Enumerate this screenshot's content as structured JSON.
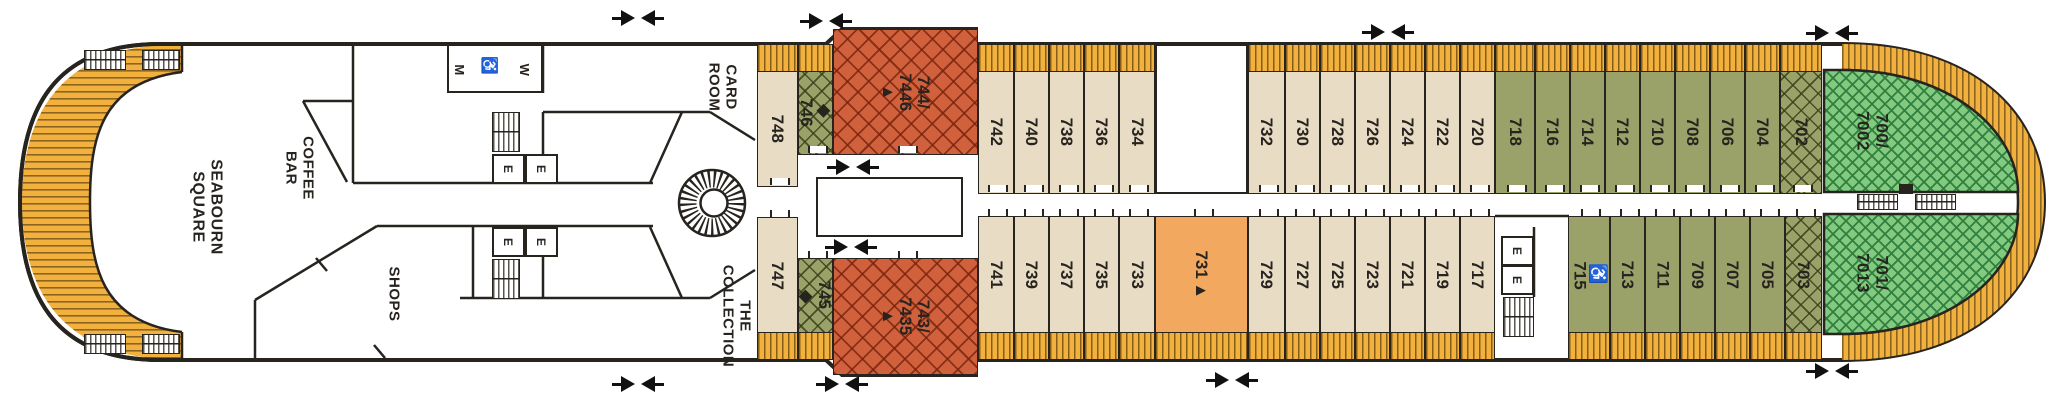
{
  "venues": {
    "seabourn_square": {
      "label": "SEABOURN\nSQUARE"
    },
    "coffee_bar": {
      "label": "COFFEE\nBAR"
    },
    "shops": {
      "label": "SHOPS"
    },
    "card_room": {
      "label": "CARD\nROOM"
    },
    "the_collection": {
      "label": "THE\nCOLLECTION"
    }
  },
  "facilities": {
    "mens": "M",
    "womens": "W",
    "elevator": "E",
    "accessible_icon": "♿"
  },
  "markers": {
    "diamond": "◆",
    "triangle": "▲"
  },
  "colors": {
    "hull_line": "#27231f",
    "cabin_beige": "#e8dcc4",
    "cabin_olive": "#9aa26a",
    "suite_red": "#d0613c",
    "suite_green": "#82ca7f",
    "suite_orange": "#f2a95f",
    "deck_yellow": "#f2b13c"
  },
  "cabins": {
    "top": [
      {
        "n": "748",
        "x": 757,
        "w": 41,
        "c": "beige",
        "f": "aft"
      },
      {
        "n": "746",
        "x": 798,
        "w": 35,
        "c": "olive-x",
        "pre": "◆",
        "f": "short"
      },
      {
        "n": "744/7446",
        "lines": [
          "744/",
          "7446"
        ],
        "x": 833,
        "w": 145,
        "c": "red-x",
        "tri": true,
        "f": "tall"
      },
      {
        "n": "742",
        "x": 978,
        "w": 36,
        "c": "beige"
      },
      {
        "n": "740",
        "x": 1014,
        "w": 35,
        "c": "beige"
      },
      {
        "n": "738",
        "x": 1049,
        "w": 35,
        "c": "beige"
      },
      {
        "n": "736",
        "x": 1084,
        "w": 35,
        "c": "beige"
      },
      {
        "n": "734",
        "x": 1119,
        "w": 36,
        "c": "beige"
      },
      {
        "n": "732",
        "x": 1248,
        "w": 37,
        "c": "beige"
      },
      {
        "n": "730",
        "x": 1285,
        "w": 35,
        "c": "beige"
      },
      {
        "n": "728",
        "x": 1320,
        "w": 35,
        "c": "beige"
      },
      {
        "n": "726",
        "x": 1355,
        "w": 35,
        "c": "beige"
      },
      {
        "n": "724",
        "x": 1390,
        "w": 35,
        "c": "beige"
      },
      {
        "n": "722",
        "x": 1425,
        "w": 35,
        "c": "beige"
      },
      {
        "n": "720",
        "x": 1460,
        "w": 35,
        "c": "beige"
      },
      {
        "n": "718",
        "x": 1495,
        "w": 40,
        "c": "olive"
      },
      {
        "n": "716",
        "x": 1535,
        "w": 35,
        "c": "olive"
      },
      {
        "n": "714",
        "x": 1570,
        "w": 35,
        "c": "olive"
      },
      {
        "n": "712",
        "x": 1605,
        "w": 35,
        "c": "olive"
      },
      {
        "n": "710",
        "x": 1640,
        "w": 35,
        "c": "olive"
      },
      {
        "n": "708",
        "x": 1675,
        "w": 35,
        "c": "olive"
      },
      {
        "n": "706",
        "x": 1710,
        "w": 35,
        "c": "olive"
      },
      {
        "n": "704",
        "x": 1745,
        "w": 35,
        "c": "olive"
      },
      {
        "n": "702",
        "x": 1780,
        "w": 42,
        "c": "olive-x"
      }
    ],
    "bottom": [
      {
        "n": "747",
        "x": 757,
        "w": 41,
        "c": "beige",
        "f": "aft"
      },
      {
        "n": "745",
        "x": 798,
        "w": 35,
        "c": "olive-x",
        "post": "◆",
        "f": "short"
      },
      {
        "n": "743/7435",
        "lines": [
          "743/",
          "7435"
        ],
        "x": 833,
        "w": 145,
        "c": "red-x",
        "tri": true,
        "f": "tall"
      },
      {
        "n": "741",
        "x": 978,
        "w": 36,
        "c": "beige"
      },
      {
        "n": "739",
        "x": 1014,
        "w": 35,
        "c": "beige"
      },
      {
        "n": "737",
        "x": 1049,
        "w": 35,
        "c": "beige"
      },
      {
        "n": "735",
        "x": 1084,
        "w": 35,
        "c": "beige"
      },
      {
        "n": "733",
        "x": 1119,
        "w": 36,
        "c": "beige"
      },
      {
        "n": "731",
        "x": 1155,
        "w": 93,
        "c": "orange",
        "post": "▲"
      },
      {
        "n": "729",
        "x": 1248,
        "w": 37,
        "c": "beige"
      },
      {
        "n": "727",
        "x": 1285,
        "w": 35,
        "c": "beige"
      },
      {
        "n": "725",
        "x": 1320,
        "w": 35,
        "c": "beige"
      },
      {
        "n": "723",
        "x": 1355,
        "w": 35,
        "c": "beige"
      },
      {
        "n": "721",
        "x": 1390,
        "w": 35,
        "c": "beige"
      },
      {
        "n": "719",
        "x": 1425,
        "w": 35,
        "c": "beige"
      },
      {
        "n": "717",
        "x": 1460,
        "w": 35,
        "c": "beige"
      },
      {
        "n": "715",
        "x": 1568,
        "w": 42,
        "c": "olive",
        "pre": "♿"
      },
      {
        "n": "713",
        "x": 1610,
        "w": 35,
        "c": "olive"
      },
      {
        "n": "711",
        "x": 1645,
        "w": 35,
        "c": "olive"
      },
      {
        "n": "709",
        "x": 1680,
        "w": 35,
        "c": "olive"
      },
      {
        "n": "707",
        "x": 1715,
        "w": 35,
        "c": "olive"
      },
      {
        "n": "705",
        "x": 1750,
        "w": 35,
        "c": "olive"
      },
      {
        "n": "703",
        "x": 1785,
        "w": 37,
        "c": "olive-x"
      }
    ]
  },
  "bow_suites": [
    {
      "n": "700/7002",
      "lines": [
        "700/",
        "7002"
      ]
    },
    {
      "n": "701/7013",
      "lines": [
        "701/",
        "7013"
      ]
    }
  ]
}
